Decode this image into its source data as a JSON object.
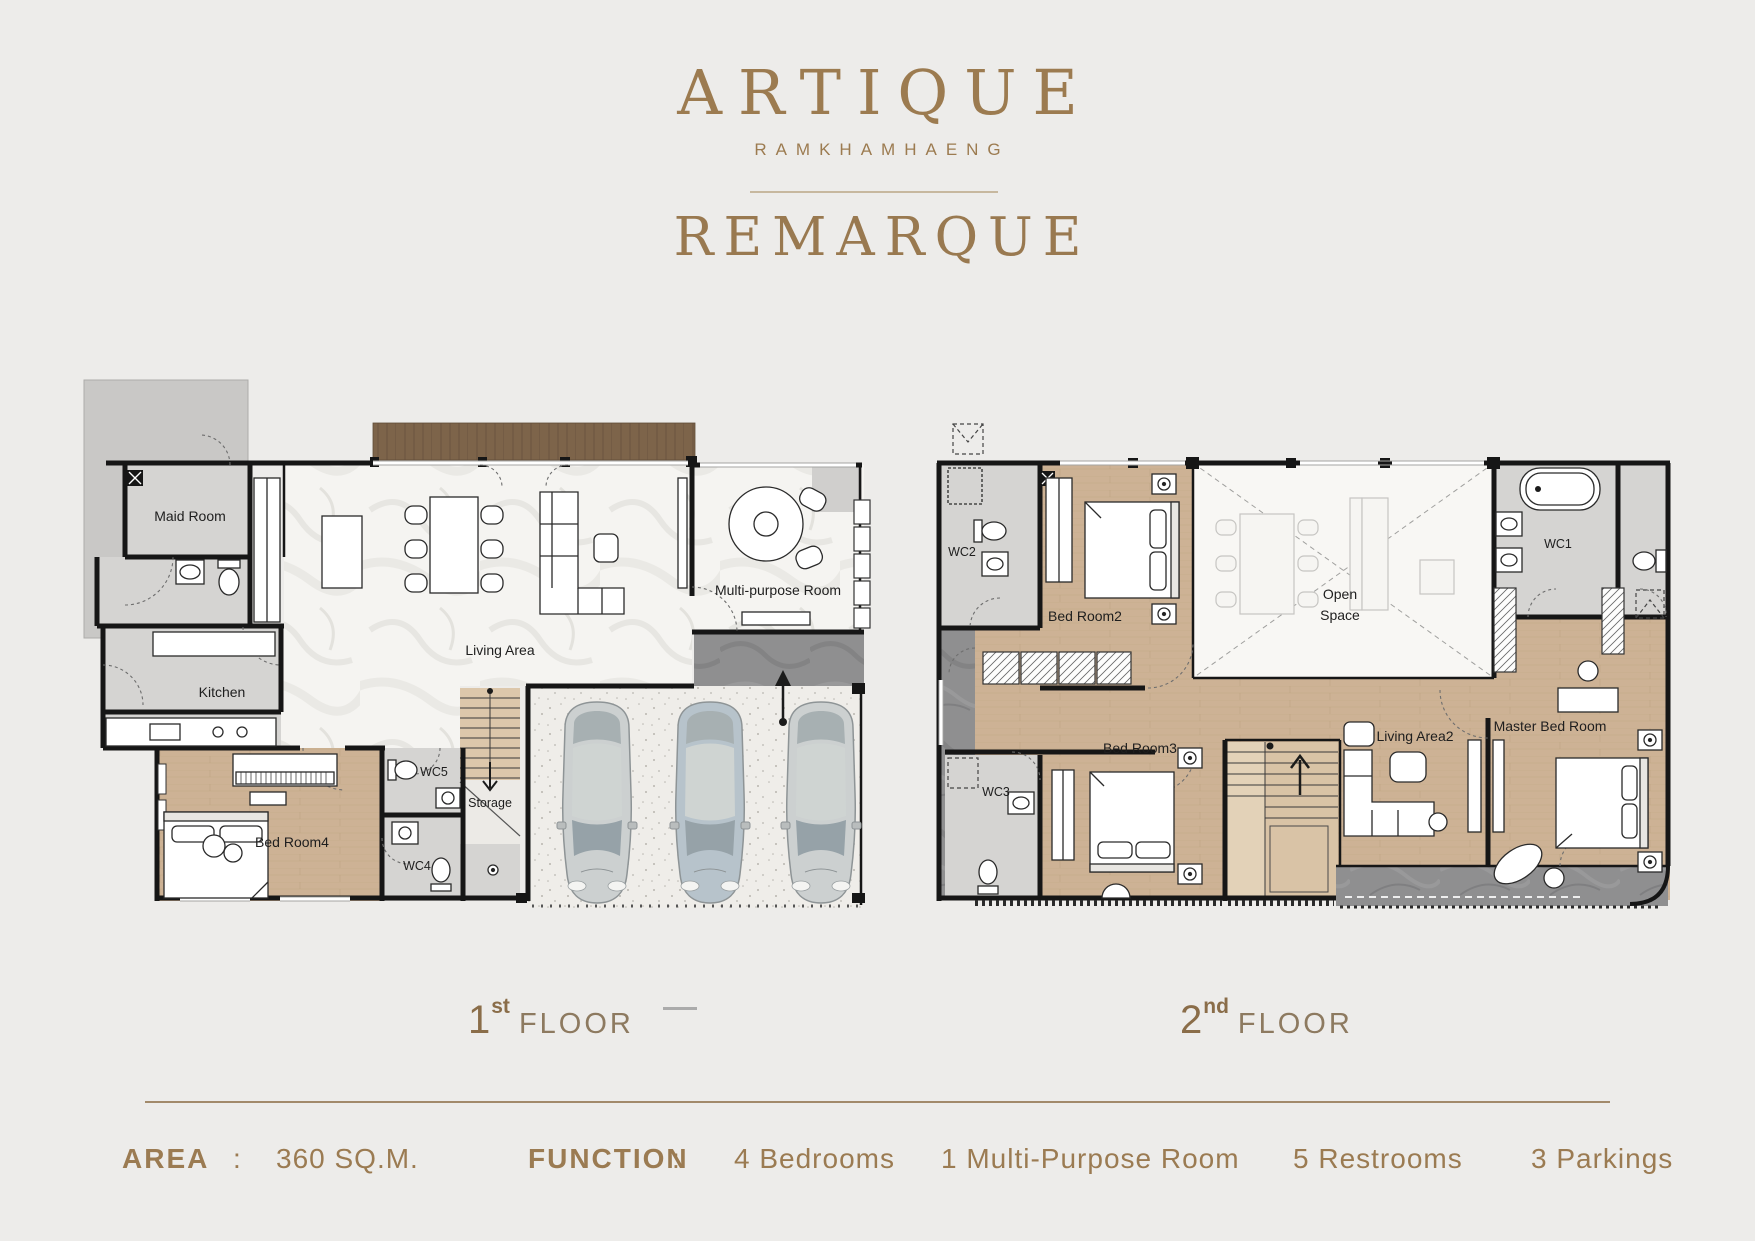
{
  "header": {
    "brand": "ARTIQUE",
    "subbrand": "RAMKHAMHAENG",
    "project": "REMARQUE"
  },
  "floor1": {
    "num": "1",
    "sup": "st",
    "word": "FLOOR"
  },
  "floor2": {
    "num": "2",
    "sup": "nd",
    "word": "FLOOR"
  },
  "plan1": {
    "rooms": {
      "maid": "Maid Room",
      "kitchen": "Kitchen",
      "living": "Living Area",
      "multi": "Multi-purpose Room",
      "wc5": "WC5",
      "storage": "Storage",
      "bed4": "Bed Room4",
      "wc4": "WC4"
    }
  },
  "plan2": {
    "rooms": {
      "wc2": "WC2",
      "bed2": "Bed Room2",
      "open1": "Open",
      "open2": "Space",
      "wc1": "WC1",
      "bed3": "Bed Room3",
      "wc3": "WC3",
      "living2": "Living Area2",
      "master": "Master Bed Room"
    }
  },
  "footer": {
    "area_label": "AREA",
    "colon": ":",
    "area_value": "360  SQ.M.",
    "function_label": "FUNCTION",
    "functions": [
      "4 Bedrooms",
      "1 Multi-Purpose Room",
      "5  Restrooms",
      "3 Parkings"
    ]
  },
  "colors": {
    "gold": "#9c7b50",
    "wall": "#161616",
    "wood": "#cdb295",
    "dark_marble": "#8f8f90"
  }
}
